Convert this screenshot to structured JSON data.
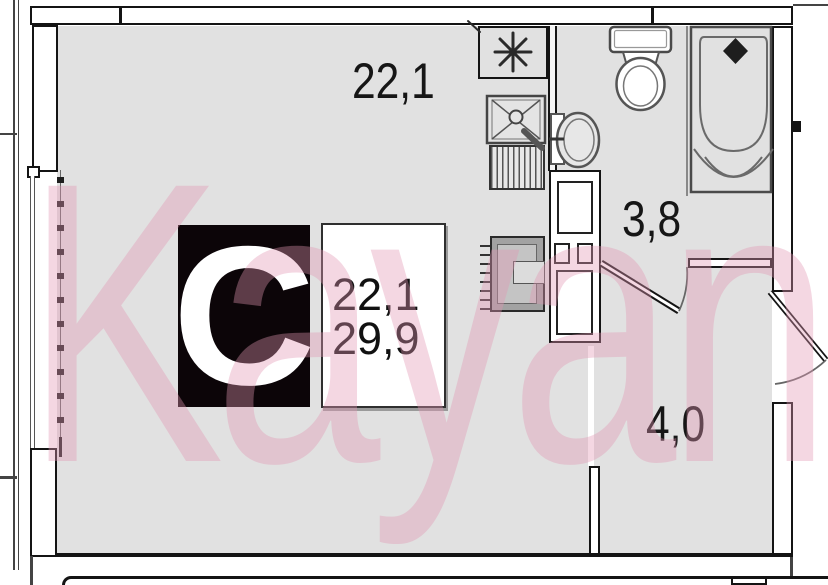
{
  "watermark": {
    "text": "Kayan",
    "color": "#e296b2"
  },
  "logo": {
    "letter": "C",
    "bg": "#0c0508"
  },
  "labels": {
    "room_area": "22,1",
    "bathroom_area": "3,8",
    "hallway_area": "4,0"
  },
  "info_box": {
    "room_area": "22,1",
    "total_area": "29,9"
  },
  "icons": {
    "vent": "asterisk-vent-icon"
  },
  "colors": {
    "floor": "#e1e1e1",
    "wall": "#141414",
    "fixture": "#555555",
    "accent_pink": "#e296b2"
  }
}
